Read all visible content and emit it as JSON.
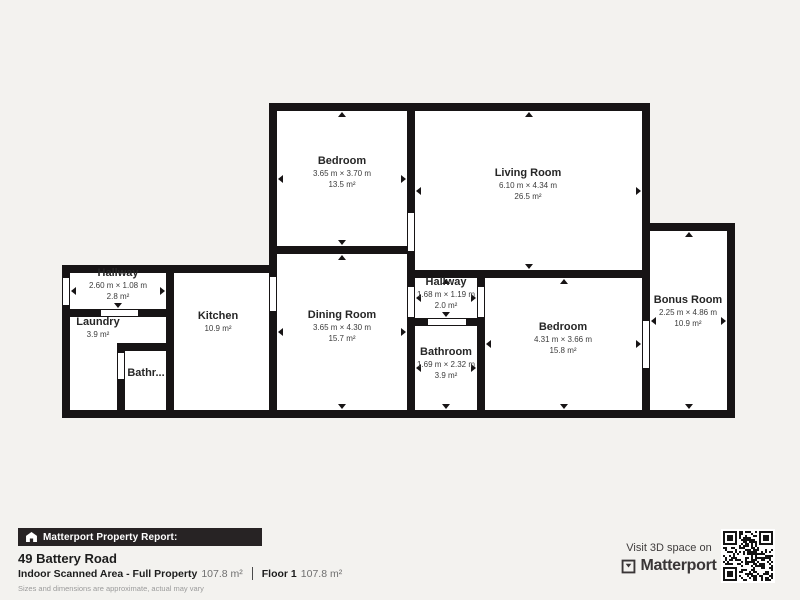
{
  "plan": {
    "rooms": {
      "bedroom_top": {
        "name": "Bedroom",
        "dims": "3.65 m × 3.70 m",
        "area": "13.5 m²"
      },
      "living_room": {
        "name": "Living Room",
        "dims": "6.10 m × 4.34 m",
        "area": "26.5 m²"
      },
      "hallway_left": {
        "name": "Hallway",
        "dims": "2.60 m × 1.08 m",
        "area": "2.8 m²"
      },
      "laundry": {
        "name": "Laundry",
        "area": "3.9 m²"
      },
      "kitchen": {
        "name": "Kitchen",
        "area": "10.9 m²"
      },
      "bathroom_small": {
        "name": "Bathr..."
      },
      "dining_room": {
        "name": "Dining Room",
        "dims": "3.65 m × 4.30 m",
        "area": "15.7 m²"
      },
      "hallway_mid": {
        "name": "Hallway",
        "dims": "1.68 m × 1.19 m",
        "area": "2.0 m²"
      },
      "bathroom": {
        "name": "Bathroom",
        "dims": "1.69 m × 2.32 m",
        "area": "3.9 m²"
      },
      "bedroom_bottom": {
        "name": "Bedroom",
        "dims": "4.31 m × 3.66 m",
        "area": "15.8 m²"
      },
      "bonus_room": {
        "name": "Bonus Room",
        "dims": "2.25 m × 4.86 m",
        "area": "10.9 m²"
      }
    }
  },
  "footer": {
    "report_label": "Matterport Property Report:",
    "address": "49 Battery Road",
    "scanned_area_label": "Indoor Scanned Area - Full Property",
    "scanned_area_value": "107.8 m²",
    "floor_label": "Floor 1",
    "floor_value": "107.8 m²",
    "disclaimer": "Sizes and dimensions are approximate, actual may vary",
    "visit_label": "Visit 3D space on",
    "brand": "Matterport"
  },
  "colors": {
    "background": "#f3f2ef",
    "wall": "#171415",
    "room_fill": "#ffffff",
    "report_bar": "#272324",
    "brand_dark": "#3a3637"
  }
}
